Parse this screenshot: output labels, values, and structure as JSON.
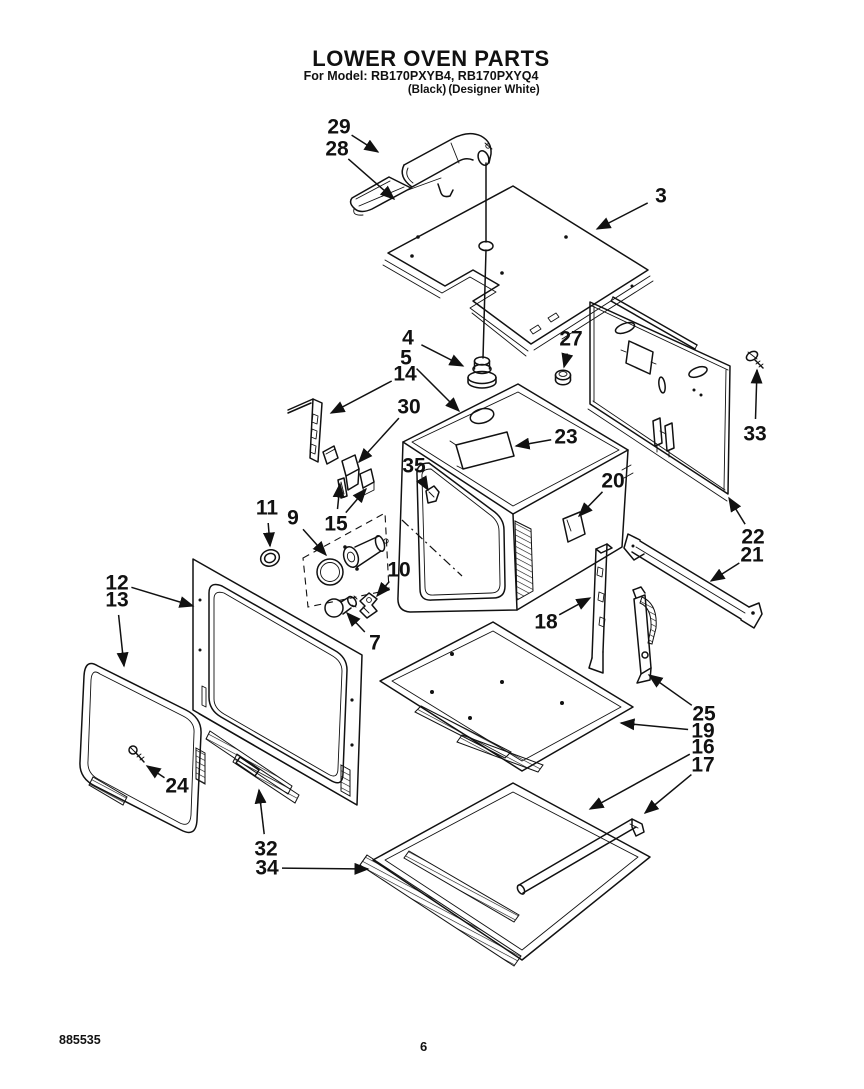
{
  "header": {
    "title": "LOWER OVEN PARTS",
    "model_line": "For Model: RB170PXYB4, RB170PXYQ4",
    "variant_black": "(Black)",
    "variant_white": "(Designer White)"
  },
  "footer": {
    "doc_number": "885535",
    "page_number": "6"
  },
  "colors": {
    "ink": "#111111",
    "background": "#ffffff"
  },
  "diagram": {
    "description": "Exploded view of lower oven parts with numbered callouts",
    "callouts": [
      {
        "label": "29",
        "x": 339,
        "y": 127,
        "tips": [
          [
            378,
            152
          ]
        ]
      },
      {
        "label": "28",
        "x": 337,
        "y": 149,
        "tips": [
          [
            394,
            199
          ]
        ]
      },
      {
        "label": "3",
        "x": 661,
        "y": 196,
        "tips": [
          [
            597,
            229
          ]
        ]
      },
      {
        "label": "4",
        "x": 408,
        "y": 338,
        "tips": [
          [
            463,
            366
          ]
        ]
      },
      {
        "label": "5",
        "x": 406,
        "y": 358,
        "tips": [
          [
            459,
            411
          ]
        ]
      },
      {
        "label": "14",
        "x": 405,
        "y": 374,
        "tips": [
          [
            331,
            413
          ]
        ]
      },
      {
        "label": "30",
        "x": 409,
        "y": 407,
        "tips": [
          [
            359,
            462
          ]
        ]
      },
      {
        "label": "23",
        "x": 566,
        "y": 437,
        "tips": [
          [
            516,
            446
          ]
        ]
      },
      {
        "label": "27",
        "x": 571,
        "y": 339,
        "tips": [
          [
            564,
            367
          ]
        ]
      },
      {
        "label": "35",
        "x": 414,
        "y": 466,
        "tips": [
          [
            428,
            490
          ]
        ]
      },
      {
        "label": "20",
        "x": 613,
        "y": 481,
        "tips": [
          [
            579,
            516
          ]
        ]
      },
      {
        "label": "33",
        "x": 755,
        "y": 434,
        "tips": [
          [
            757,
            370
          ]
        ]
      },
      {
        "label": "22",
        "x": 753,
        "y": 537,
        "tips": [
          [
            729,
            498
          ]
        ]
      },
      {
        "label": "21",
        "x": 752,
        "y": 555,
        "tips": [
          [
            711,
            581
          ]
        ]
      },
      {
        "label": "11",
        "x": 267,
        "y": 508,
        "tips": [
          [
            270,
            546
          ]
        ]
      },
      {
        "label": "9",
        "x": 293,
        "y": 518,
        "tips": [
          [
            326,
            555
          ]
        ]
      },
      {
        "label": "15",
        "x": 336,
        "y": 524,
        "tips": [
          [
            340,
            484
          ],
          [
            366,
            489
          ]
        ]
      },
      {
        "label": "10",
        "x": 399,
        "y": 570,
        "tips": [
          [
            377,
            596
          ]
        ]
      },
      {
        "label": "7",
        "x": 375,
        "y": 643,
        "tips": [
          [
            347,
            613
          ]
        ]
      },
      {
        "label": "12",
        "x": 117,
        "y": 583,
        "tips": [
          [
            193,
            606
          ]
        ]
      },
      {
        "label": "13",
        "x": 117,
        "y": 600,
        "tips": [
          [
            124,
            666
          ]
        ]
      },
      {
        "label": "24",
        "x": 177,
        "y": 786,
        "tips": [
          [
            147,
            766
          ]
        ]
      },
      {
        "label": "32",
        "x": 266,
        "y": 849,
        "tips": [
          [
            259,
            790
          ]
        ]
      },
      {
        "label": "34",
        "x": 267,
        "y": 868,
        "tips": [
          [
            368,
            869
          ]
        ]
      },
      {
        "label": "18",
        "x": 546,
        "y": 622,
        "tips": [
          [
            590,
            598
          ]
        ]
      },
      {
        "label": "25",
        "x": 704,
        "y": 714,
        "tips": [
          [
            649,
            675
          ]
        ]
      },
      {
        "label": "19",
        "x": 703,
        "y": 731,
        "tips": [
          [
            621,
            723
          ]
        ]
      },
      {
        "label": "16",
        "x": 703,
        "y": 747,
        "tips": [
          [
            590,
            809
          ]
        ]
      },
      {
        "label": "17",
        "x": 703,
        "y": 765,
        "tips": [
          [
            645,
            813
          ]
        ]
      }
    ]
  }
}
